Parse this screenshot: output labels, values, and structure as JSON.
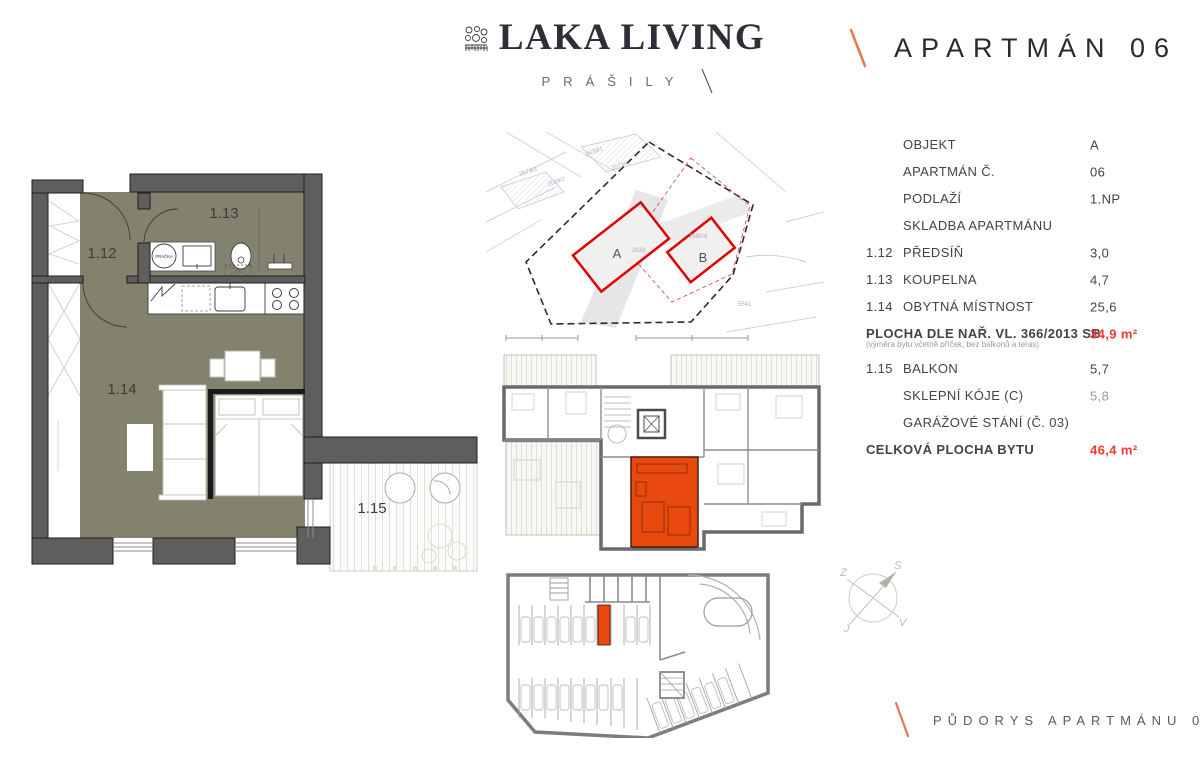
{
  "header": {
    "logo": {
      "name": "LAKA LIVING",
      "subtitle": "PRÁŠILY",
      "ornament_icon": "ornament-stamp-icon"
    },
    "title": "APARTMÁN 06"
  },
  "colors": {
    "accent_orange": "#E8490F",
    "accent_red": "#EE3A30",
    "slash_orange": "#E8764E",
    "floor_olive": "#82826F",
    "wall_gray": "#5F5E5C"
  },
  "floor_plan": {
    "rooms": {
      "hall": "1.12",
      "bathroom": "1.13",
      "living": "1.14",
      "balcony": "1.15"
    },
    "washer_label": "PRAČKA"
  },
  "site_plan": {
    "building_a": "A",
    "building_b": "B",
    "parcels": [
      "2639/1",
      "2579/4",
      "2579/3",
      "2639/2",
      "2633",
      "2580/8",
      "5541"
    ]
  },
  "compass": {
    "north": "S",
    "west": "Z",
    "east": "V",
    "south": "J"
  },
  "info_table": {
    "rows": [
      {
        "num": "",
        "label": "OBJEKT",
        "value": "A"
      },
      {
        "num": "",
        "label": "APARTMÁN Č.",
        "value": "06"
      },
      {
        "num": "",
        "label": "PODLAŽÍ",
        "value": "1.NP"
      },
      {
        "num": "",
        "label": "SKLADBA APARTMÁNU",
        "value": ""
      },
      {
        "num": "1.12",
        "label": "PŘEDSÍŇ",
        "value": "3,0"
      },
      {
        "num": "1.13",
        "label": "KOUPELNA",
        "value": "4,7"
      },
      {
        "num": "1.14",
        "label": "OBYTNÁ MÍSTNOST",
        "value": "25,6"
      },
      {
        "num": "",
        "label": "PLOCHA DLE NAŘ. VL. 366/2013 SB.",
        "value": "34,9 m²"
      },
      {
        "num": "1.15",
        "label": "BALKON",
        "value": "5,7"
      },
      {
        "num": "",
        "label": "SKLEPNÍ KÓJE (C)",
        "value": "5,8"
      },
      {
        "num": "",
        "label": "GARÁŽOVÉ STÁNÍ (Č. 03)",
        "value": ""
      },
      {
        "num": "",
        "label": "CELKOVÁ PLOCHA BYTU",
        "value": "46,4 m²"
      }
    ],
    "area_note": "(výměra bytu včetně příček, bez balkonů a teras)"
  },
  "footer": {
    "caption": "PŮDORYS APARTMÁNU 06"
  }
}
